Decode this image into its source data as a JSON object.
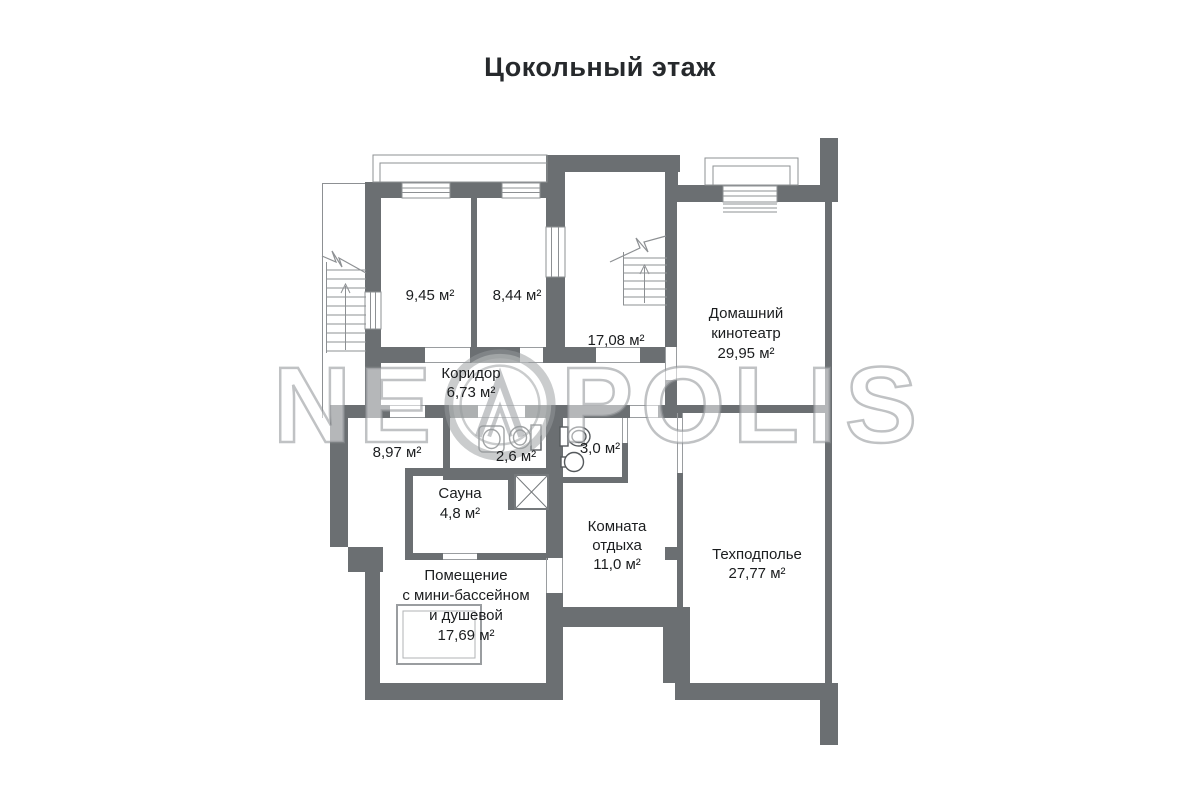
{
  "title": "Цокольный этаж",
  "watermark": {
    "prefix": "NE",
    "suffix": "POLIS"
  },
  "rooms": {
    "room1": {
      "area": "9,45 м²"
    },
    "room2": {
      "area": "8,44 м²"
    },
    "room3": {
      "area": "17,08 м²"
    },
    "cinema": {
      "name_line1": "Домашний",
      "name_line2": "кинотеатр",
      "area": "29,95 м²"
    },
    "corridor": {
      "name": "Коридор",
      "area": "6,73 м²"
    },
    "room897": {
      "area": "8,97 м²"
    },
    "bath26": {
      "area": "2,6 м²"
    },
    "bath30": {
      "area": "3,0 м²"
    },
    "sauna": {
      "name": "Сауна",
      "area": "4,8 м²"
    },
    "rest": {
      "name_line1": "Комната",
      "name_line2": "отдыха",
      "area": "11,0 м²"
    },
    "pool": {
      "name_line1": "Помещение",
      "name_line2": "с мини-бассейном",
      "name_line3": "и душевой",
      "area": "17,69 м²"
    },
    "tech": {
      "name": "Техподполье",
      "area": "27,77 м²"
    }
  },
  "colors": {
    "wall": "#6b6f72",
    "thin_line": "#8d9093",
    "fixture": "#55595c"
  }
}
